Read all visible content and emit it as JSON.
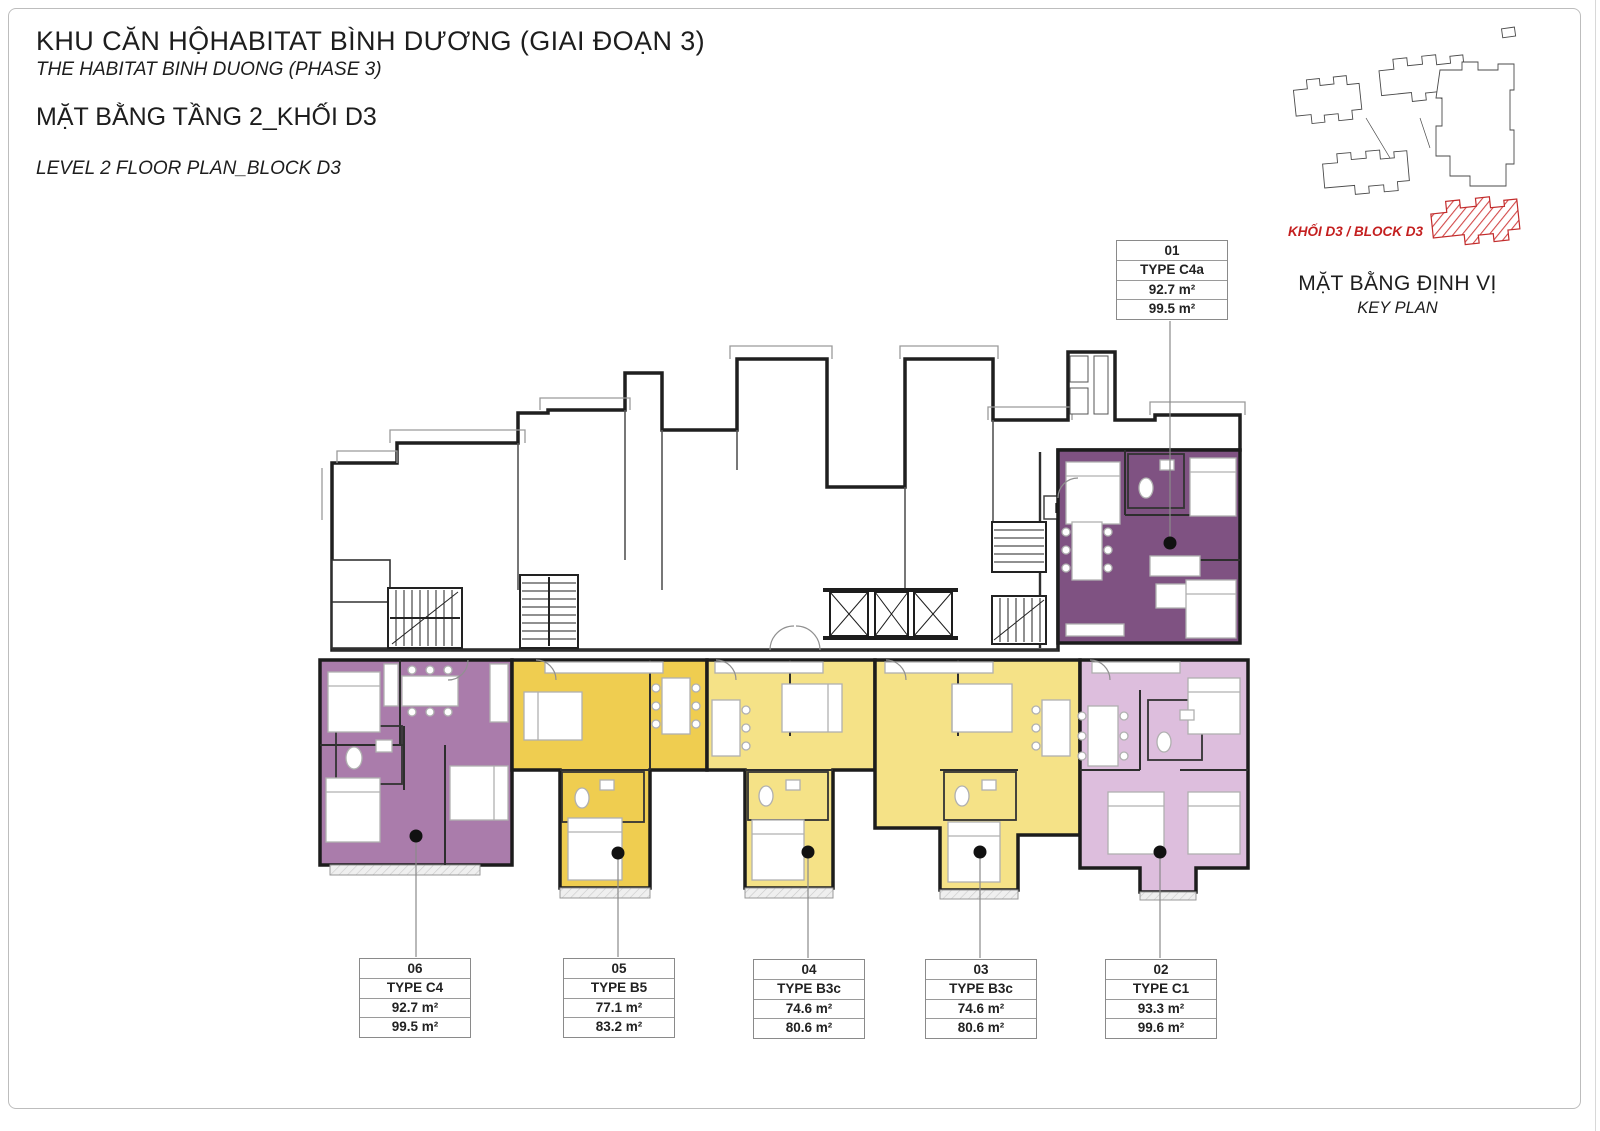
{
  "header": {
    "project_title_vi": "KHU CĂN HỘHABITAT BÌNH DƯƠNG (GIAI ĐOẠN 3)",
    "project_title_en": "THE HABITAT BINH DUONG (PHASE 3)",
    "plan_title_vi": "MẶT BẰNG TẦNG 2_KHỐI D3",
    "plan_title_en": "LEVEL 2 FLOOR PLAN_BLOCK D3"
  },
  "key_plan": {
    "block_label": "KHỐI D3 / BLOCK D3",
    "title_vi": "MẶT BẰNG ĐỊNH VỊ",
    "title_en": "KEY PLAN",
    "highlight_color": "#c41f1f"
  },
  "plan": {
    "dn_label": "DN",
    "units": [
      {
        "number": "01",
        "type": "TYPE C4a",
        "area_net": "92.7 m²",
        "area_gross": "99.5 m²",
        "color": "#7f5282"
      },
      {
        "number": "02",
        "type": "TYPE C1",
        "area_net": "93.3 m²",
        "area_gross": "99.6 m²",
        "color": "#ddbedd"
      },
      {
        "number": "03",
        "type": "TYPE B3c",
        "area_net": "74.6 m²",
        "area_gross": "80.6 m²",
        "color": "#f5e287"
      },
      {
        "number": "04",
        "type": "TYPE B3c",
        "area_net": "74.6 m²",
        "area_gross": "80.6 m²",
        "color": "#f5e287"
      },
      {
        "number": "05",
        "type": "TYPE B5",
        "area_net": "77.1 m²",
        "area_gross": "83.2 m²",
        "color": "#efcd50"
      },
      {
        "number": "06",
        "type": "TYPE C4",
        "area_net": "92.7 m²",
        "area_gross": "99.5 m²",
        "color": "#aa7cab"
      }
    ]
  }
}
